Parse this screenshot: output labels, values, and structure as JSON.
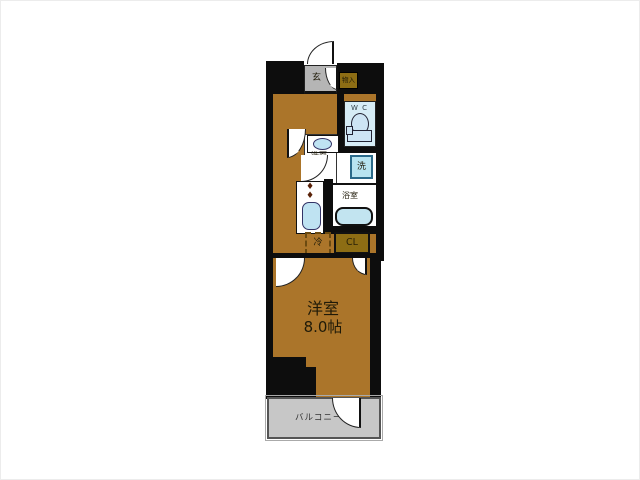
{
  "plan": {
    "type": "japanese-apartment-floor-plan",
    "rooms": {
      "entrance": {
        "label": "玄"
      },
      "storage": {
        "label": "物入"
      },
      "wc": {
        "label": "W C"
      },
      "washroom": {
        "label": "洗面"
      },
      "washer": {
        "label": "洗"
      },
      "bathroom": {
        "label": "浴室"
      },
      "refrigerator": {
        "label": "冷"
      },
      "closet": {
        "label": "CL"
      },
      "main_room": {
        "label": "洋室",
        "size": "8.0帖"
      },
      "balcony": {
        "label": "バルコニー"
      }
    },
    "icons": {
      "stove_burner": "♦"
    },
    "colors": {
      "wall": "#0d0d0d",
      "room_floor": "#ab752a",
      "closet_fill": "#8d6d14",
      "entrance_gray": "#b5b5b5",
      "balcony_gray": "#c7c7c7",
      "wc_fill": "#d6ecf6",
      "fixture_fill": "#c3e5f2",
      "text": "#1f1a08"
    }
  }
}
